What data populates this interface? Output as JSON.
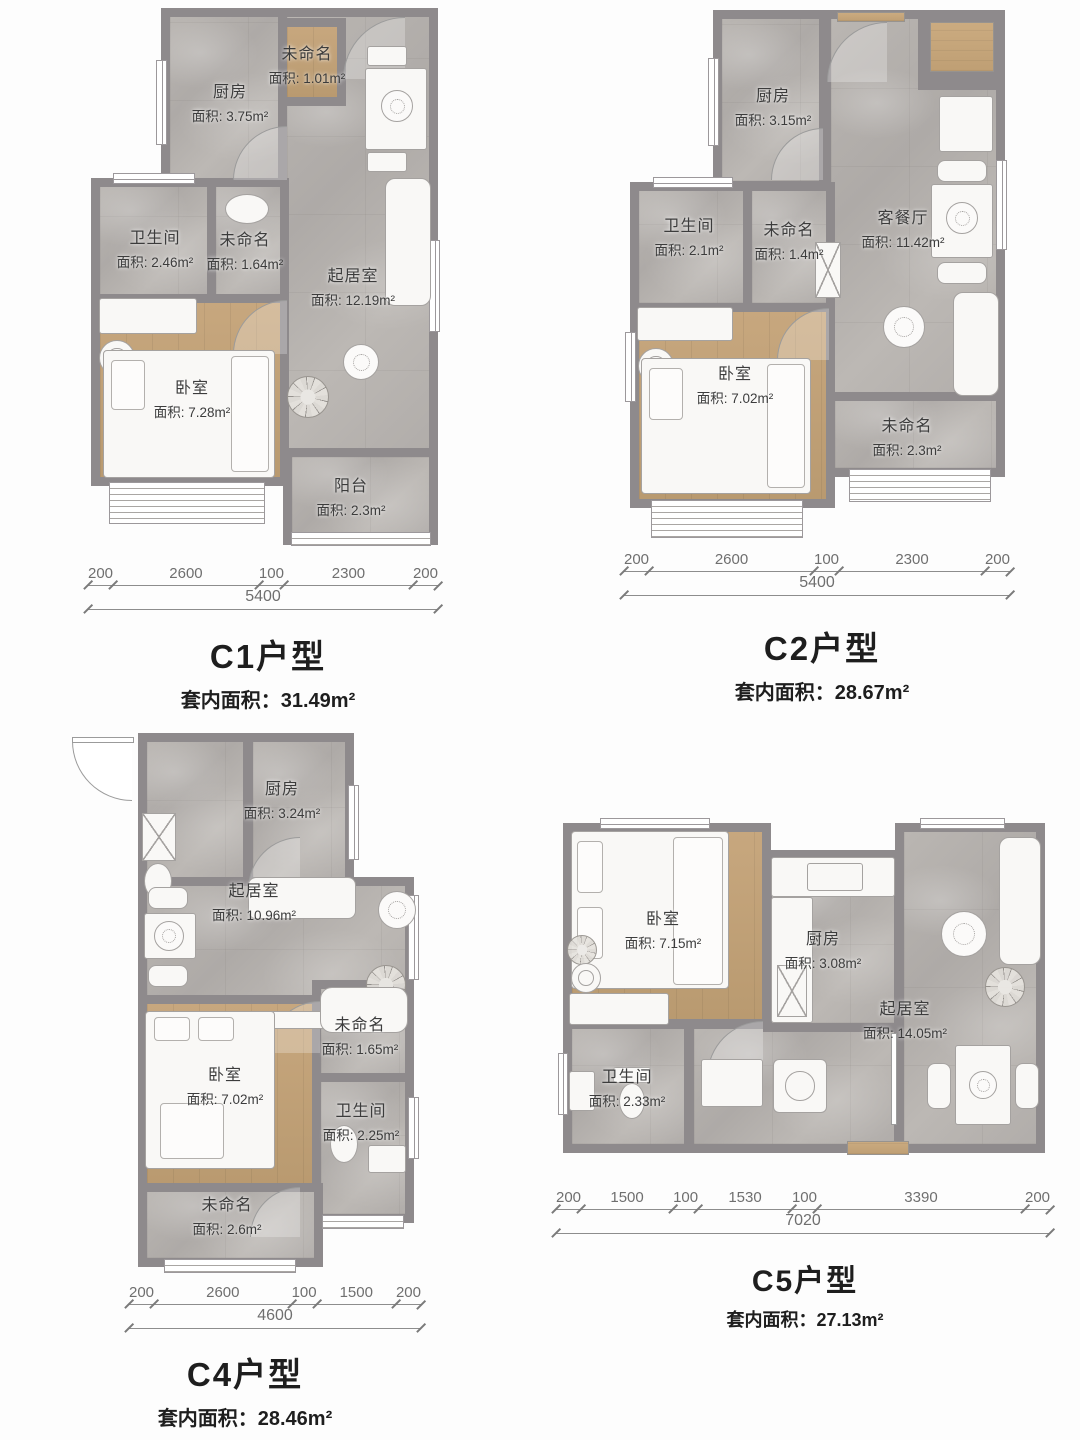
{
  "colors": {
    "wall": "#8e8a8c",
    "marble_floor": "#b3afac",
    "wood_floor": "#c0a077",
    "furniture": "#f9f8f6",
    "text": "#3c3c3c",
    "dimension_text": "#6f6f6f"
  },
  "plans": [
    {
      "id": "C1",
      "title": "C1户型",
      "area_total": "套内面积：31.49m²",
      "rooms": [
        {
          "name": "厨房",
          "area": "面积: 3.75m²"
        },
        {
          "name": "未命名",
          "area": "面积: 1.01m²"
        },
        {
          "name": "卫生间",
          "area": "面积: 2.46m²"
        },
        {
          "name": "未命名",
          "area": "面积: 1.64m²"
        },
        {
          "name": "起居室",
          "area": "面积: 12.19m²"
        },
        {
          "name": "卧室",
          "area": "面积: 7.28m²"
        },
        {
          "name": "阳台",
          "area": "面积: 2.3m²"
        }
      ],
      "dims": {
        "segments": [
          "200",
          "2600",
          "100",
          "2300",
          "200"
        ],
        "total": "5400"
      }
    },
    {
      "id": "C2",
      "title": "C2户型",
      "area_total": "套内面积：28.67m²",
      "rooms": [
        {
          "name": "厨房",
          "area": "面积: 3.15m²"
        },
        {
          "name": "卫生间",
          "area": "面积: 2.1m²"
        },
        {
          "name": "未命名",
          "area": "面积: 1.4m²"
        },
        {
          "name": "客餐厅",
          "area": "面积: 11.42m²"
        },
        {
          "name": "卧室",
          "area": "面积: 7.02m²"
        },
        {
          "name": "未命名",
          "area": "面积: 2.3m²"
        }
      ],
      "dims": {
        "segments": [
          "200",
          "2600",
          "100",
          "2300",
          "200"
        ],
        "total": "5400"
      }
    },
    {
      "id": "C4",
      "title": "C4户型",
      "area_total": "套内面积：28.46m²",
      "rooms": [
        {
          "name": "厨房",
          "area": "面积: 3.24m²"
        },
        {
          "name": "起居室",
          "area": "面积: 10.96m²"
        },
        {
          "name": "未命名",
          "area": "面积: 1.65m²"
        },
        {
          "name": "卧室",
          "area": "面积: 7.02m²"
        },
        {
          "name": "卫生间",
          "area": "面积: 2.25m²"
        },
        {
          "name": "未命名",
          "area": "面积: 2.6m²"
        }
      ],
      "dims": {
        "segments": [
          "200",
          "2600",
          "100",
          "1500",
          "200"
        ],
        "total": "4600"
      }
    },
    {
      "id": "C5",
      "title": "C5户型",
      "area_total": "套内面积：27.13m²",
      "rooms": [
        {
          "name": "卧室",
          "area": "面积: 7.15m²"
        },
        {
          "name": "厨房",
          "area": "面积: 3.08m²"
        },
        {
          "name": "起居室",
          "area": "面积: 14.05m²"
        },
        {
          "name": "卫生间",
          "area": "面积: 2.33m²"
        }
      ],
      "dims": {
        "segments": [
          "200",
          "1500",
          "100",
          "1530",
          "100",
          "3390",
          "200"
        ],
        "total": "7020"
      }
    }
  ]
}
